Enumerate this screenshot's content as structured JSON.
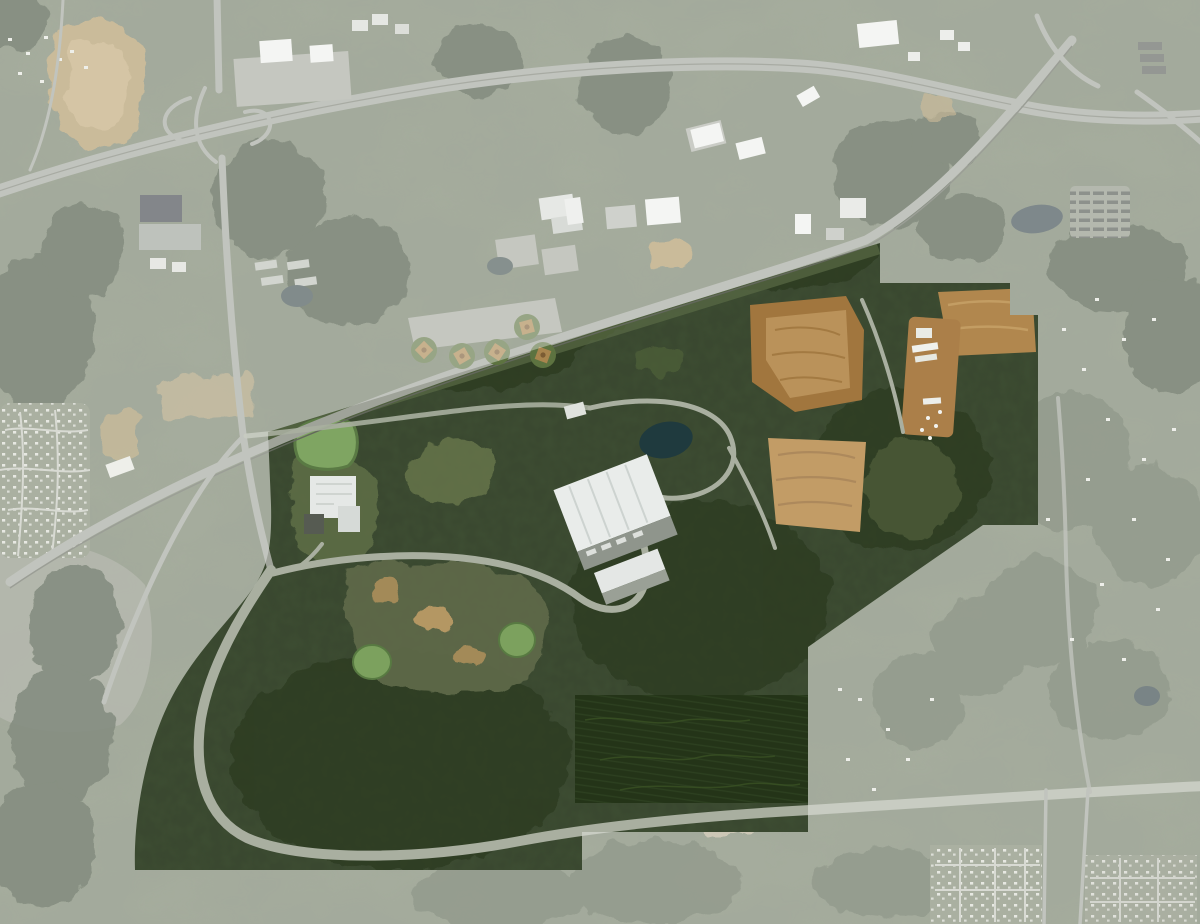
{
  "page": {
    "title": "Aerial site map with highlighted parcel",
    "visible_text": []
  },
  "map": {
    "type": "satellite-aerial",
    "description": "Aerial photograph. The surrounding region is dimmed with a translucent white wash; an irregular forested industrial-park parcel in the center remains at full saturation. An interstate-style highway crosses the top, a rail/highway corridor runs diagonally along the parcel's north edge, and a wide curving parkway sweeps around the parcel's west and south sides.",
    "highlighted_parcel": {
      "dim_color": "#ffffff",
      "dim_opacity": "0.36",
      "outline_path": "M0 0 H1200 V924 H0 Z M268 432 L880 243 L880 283 L1010 283 L1010 315 L1038 315 L1038 525 L983 525 L915 572 L808 647 L808 832 L582 832 L582 870 L135 870 C133 812 148 736 178 686 C204 642 240 610 257 582 C268 563 272 545 271 505 Z",
      "clip_path": "M268 432 L880 243 L880 283 L1010 283 L1010 315 L1038 315 L1038 525 L983 525 L915 572 L808 647 L808 832 L582 832 L582 870 L135 870 C133 812 148 736 178 686 C204 642 240 610 257 582 C268 563 272 545 271 505 Z"
    },
    "palette": {
      "terrain_base": "#6f7a64",
      "forest": "#42503a",
      "parcel_forest": "#3a4830",
      "deep_forest": "#2e3c24",
      "pine_plantation": "#243418",
      "road": "#9fa399",
      "parcel_road": "#a9afa0",
      "building_white": "#eef0ec",
      "roof_dark": "#3d4248",
      "dirt_tan": "#b49861",
      "graded_pad_brown": "#a1763e",
      "graded_pad_tan": "#c09a62",
      "pond_green": "#7fa562",
      "pond_dark": "#1f3a3e"
    },
    "landmarks": {
      "northwest": [
        "interstate-interchange",
        "big-box-retail-store",
        "shopping-plaza",
        "large-dirt-field"
      ],
      "north": [
        "baseball-field-complex",
        "school-campus",
        "office-buildings"
      ],
      "northeast": [
        "highway-interchange",
        "apartment-complex",
        "railroad-overpass"
      ],
      "parcel": [
        "large-white-warehouse",
        "second-warehouse",
        "office-campus-building",
        "green-retention-pond",
        "dark-pond",
        "graded-dirt-pads",
        "construction-laydown-yard",
        "pine-plantation",
        "loop-road",
        "curving-parkway"
      ],
      "south": [
        "residential-subdivision-grid",
        "bottom-highway"
      ],
      "west": [
        "residential-subdivision",
        "rail-highway-corridor",
        "open-gray-field"
      ]
    }
  }
}
